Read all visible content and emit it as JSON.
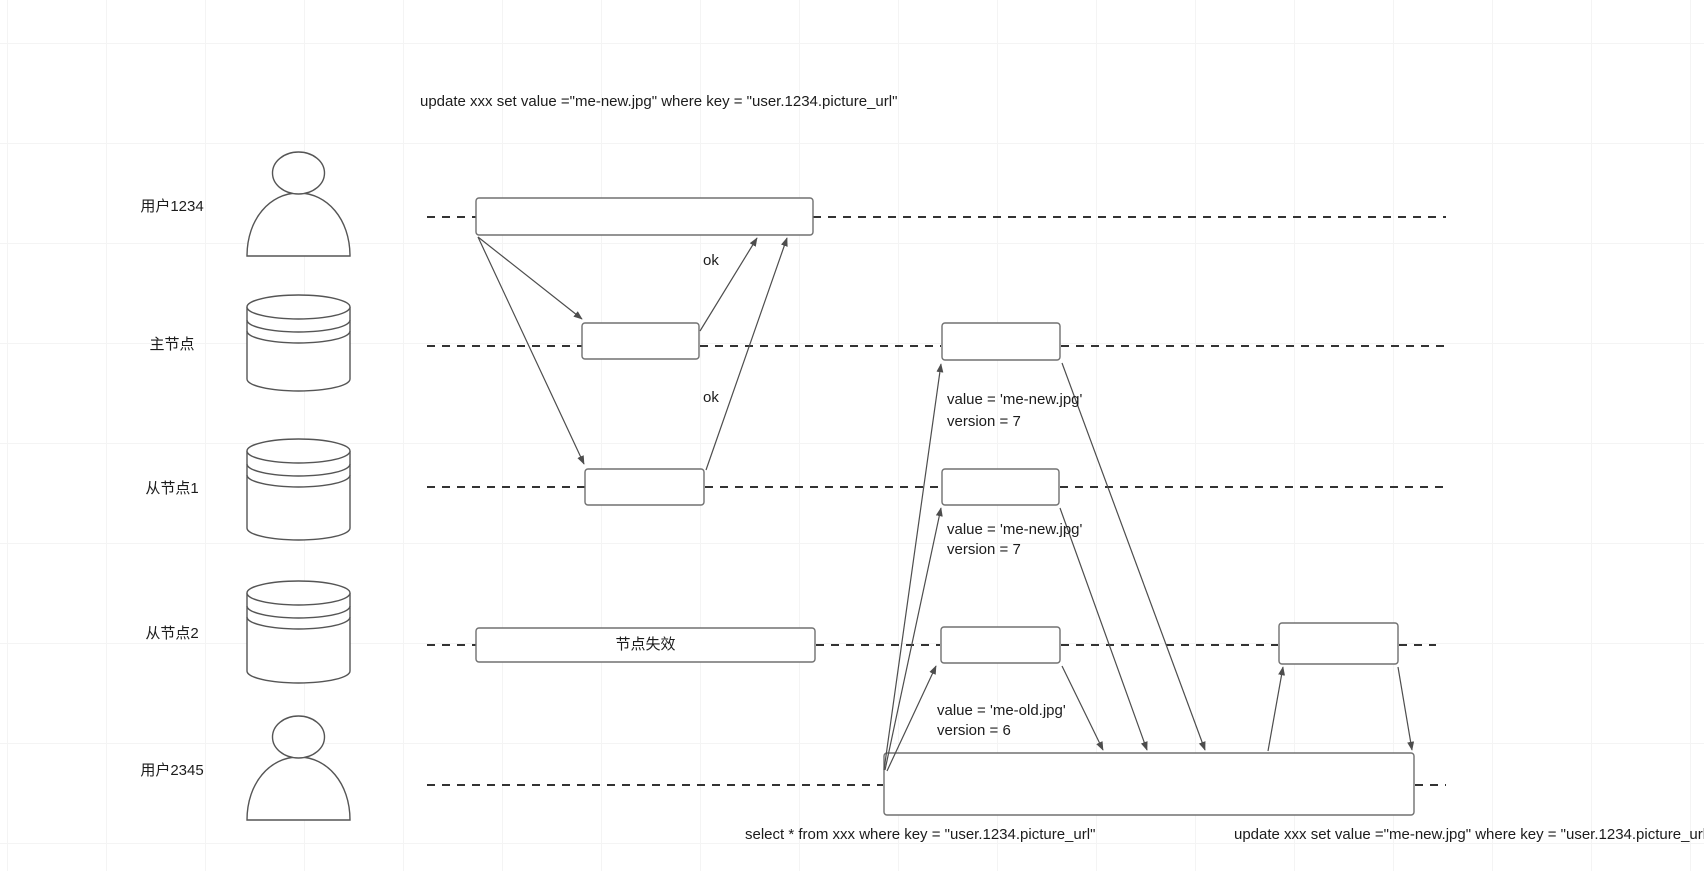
{
  "diagram": {
    "title_sql_top": "update xxx set value =\"me-new.jpg\" where key = \"user.1234.picture_url\"",
    "sql_bottom_left": "select * from xxx where key = \"user.1234.picture_url\"",
    "sql_bottom_right": "update xxx set value =\"me-new.jpg\" where key = \"user.1234.picture_url\"",
    "lanes": [
      {
        "label": "用户1234",
        "icon": "person"
      },
      {
        "label": "主节点",
        "icon": "database"
      },
      {
        "label": "从节点1",
        "icon": "database"
      },
      {
        "label": "从节点2",
        "icon": "database"
      },
      {
        "label": "用户2345",
        "icon": "person"
      }
    ],
    "annotations": {
      "ok_master": "ok",
      "ok_slave1": "ok",
      "master_value": "value = 'me-new.jpg'",
      "master_version": "version = 7",
      "slave1_value": "value = 'me-new.jpg'",
      "slave1_version": "version = 7",
      "slave2_value": "value = 'me-old.jpg'",
      "slave2_version": "version = 6",
      "node_fail": "节点失效"
    },
    "colors": {
      "background": "#ffffff",
      "grid": "#f4f4f4",
      "lifeline": "#333333",
      "box_border": "#707070",
      "arrow": "#4d4d4d",
      "text": "#1c1c1c"
    }
  }
}
